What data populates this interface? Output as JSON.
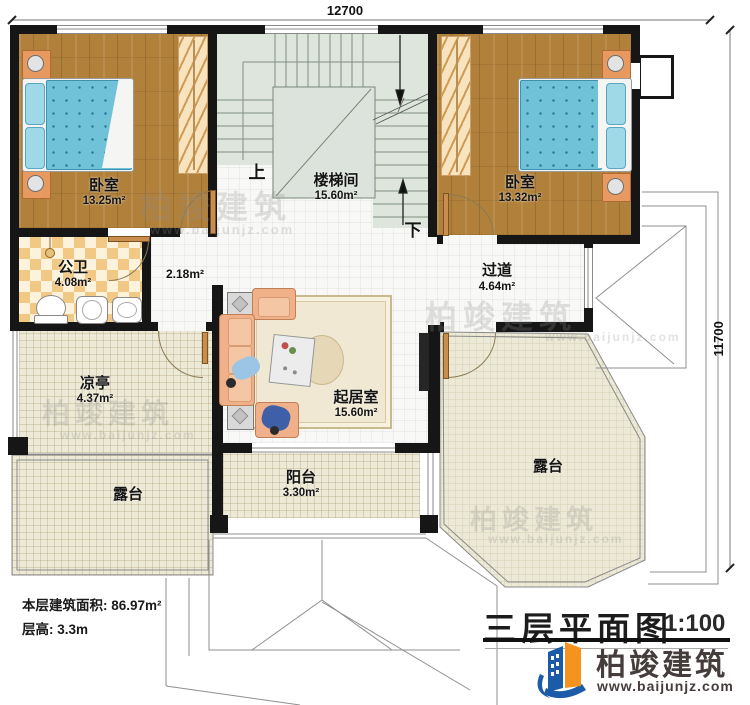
{
  "dimensions": {
    "top": "12700",
    "right": "11700"
  },
  "rooms": {
    "bedroom_left": {
      "name": "卧室",
      "area": "13.25m²"
    },
    "stairwell": {
      "name": "楼梯间",
      "area": "15.60m²"
    },
    "bedroom_right": {
      "name": "卧室",
      "area": "13.32m²"
    },
    "bathroom": {
      "name": "公卫",
      "area": "4.08m²"
    },
    "lobby": {
      "area": "2.18m²"
    },
    "hallway": {
      "name": "过道",
      "area": "4.64m²"
    },
    "pavilion": {
      "name": "凉亭",
      "area": "4.37m²"
    },
    "living_room": {
      "name": "起居室",
      "area": "15.60m²"
    },
    "balcony": {
      "name": "阳台",
      "area": "3.30m²"
    },
    "terrace_left": {
      "name": "露台"
    },
    "terrace_right": {
      "name": "露台"
    }
  },
  "stairs": {
    "up_label": "上",
    "down_label": "下"
  },
  "info": {
    "floor_area_label": "本层建筑面积: 86.97m²",
    "floor_height_label": "层高: 3.3m"
  },
  "title": {
    "name": "三层平面图",
    "scale": "1:100"
  },
  "brand": {
    "company": "柏竣建筑",
    "website": "www.baijunjz.com"
  },
  "watermark": {
    "text": "柏竣建筑",
    "url": "www.baijunjz.com"
  },
  "colors": {
    "wall": "#161616",
    "wood_floor": "#b1803a",
    "bed": "#6fc2d8",
    "stair_floor": "#dde5dd",
    "terrace_floor": "#ece9d6",
    "bath_checker": "#f2c885",
    "sofa": "#efb08a",
    "logo_blue": "#1c5ba8",
    "logo_orange": "#f6921e"
  }
}
